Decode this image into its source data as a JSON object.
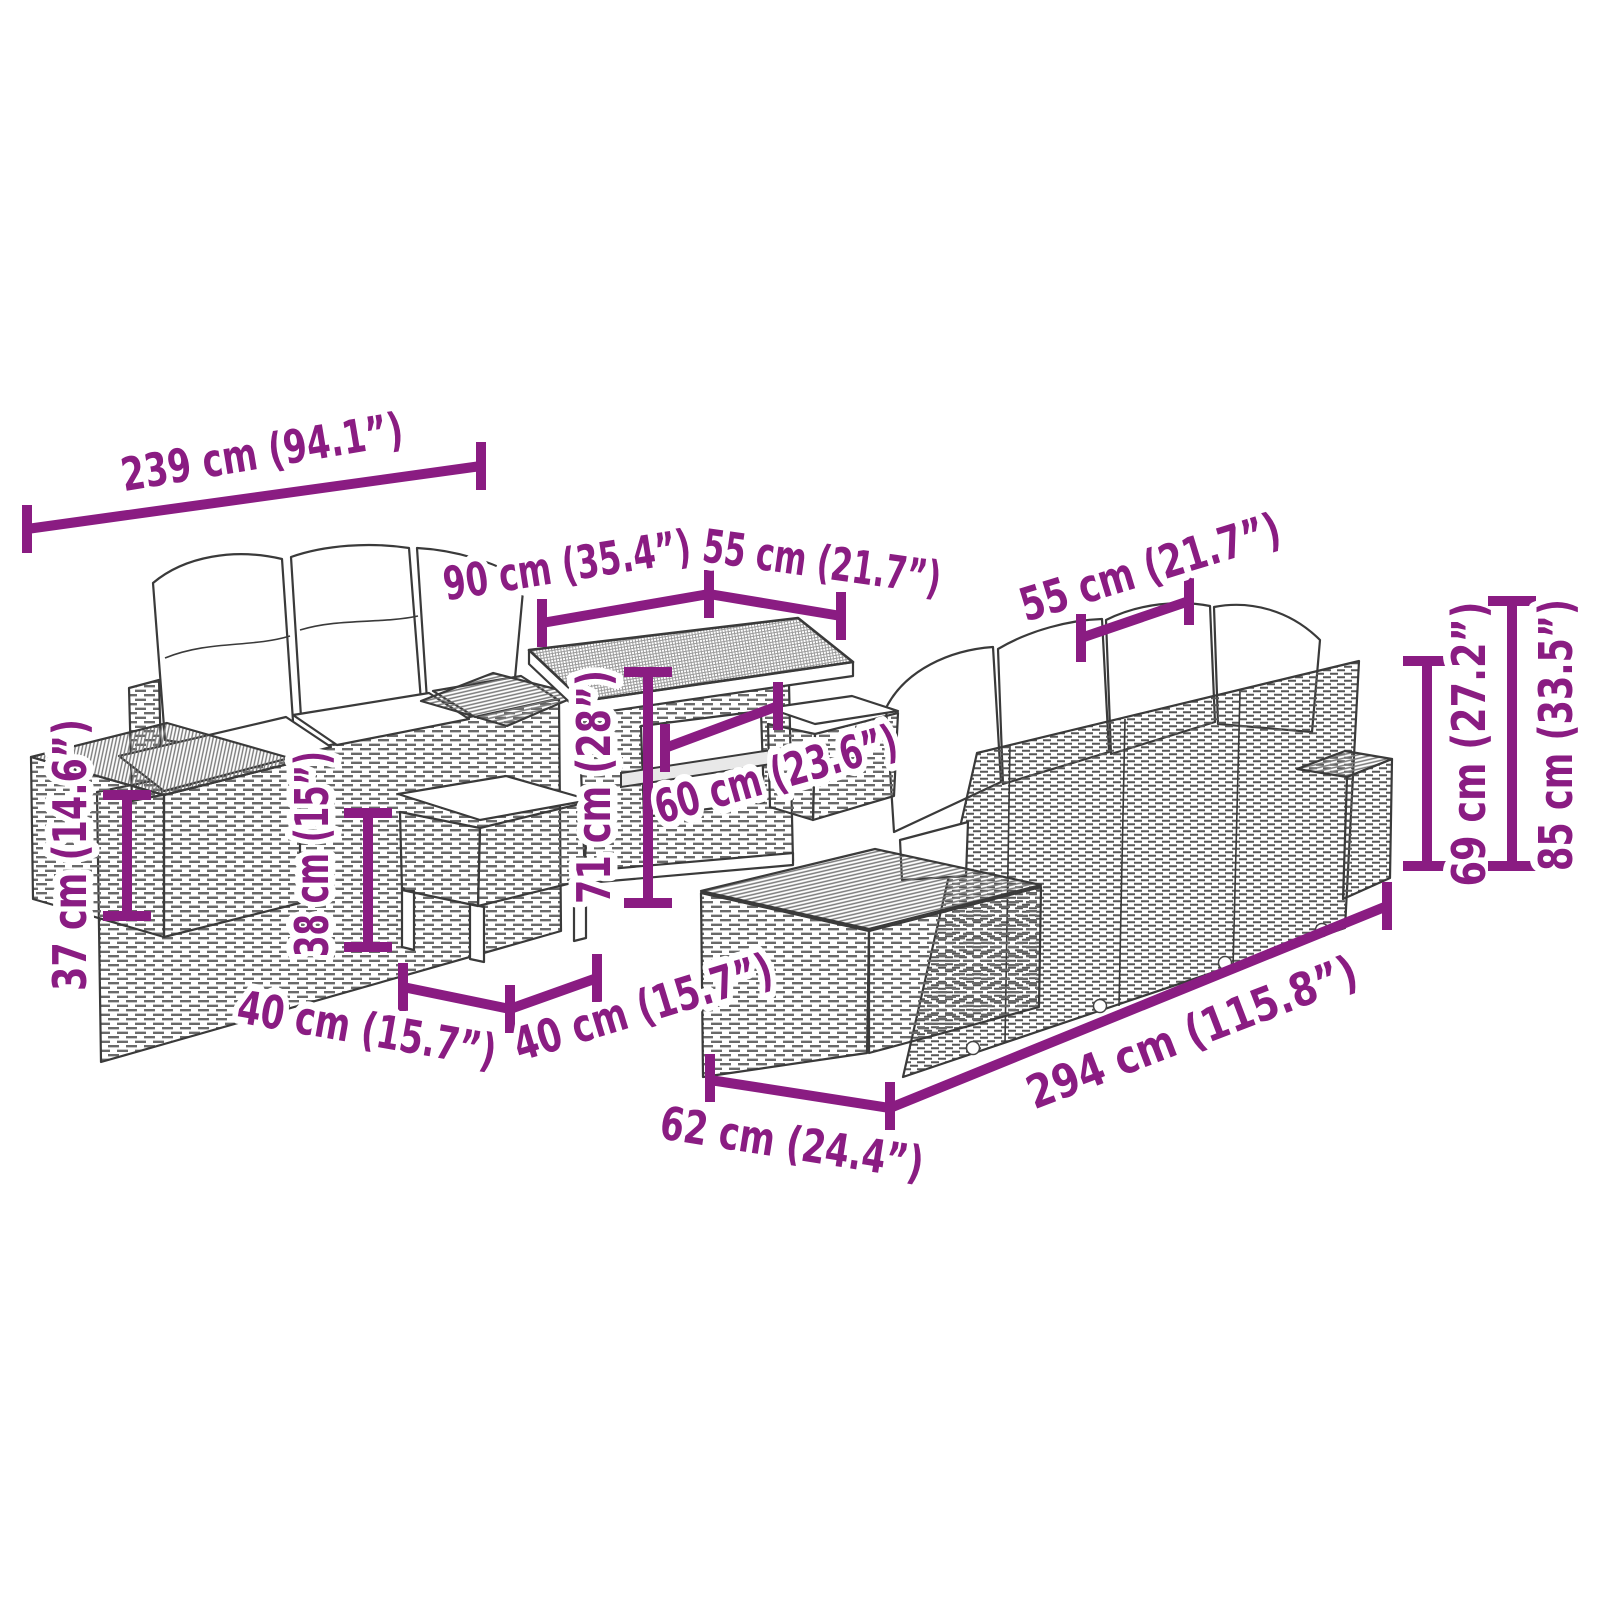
{
  "page": {
    "background": "#ffffff",
    "accent_color": "#8A1C82",
    "line_color": "#3a3a3a",
    "type": "product-dimension-diagram"
  },
  "furniture": [
    "three-seater-garden-sofa-with-cushions",
    "left-side-table",
    "garden-stool-with-cushion",
    "adjustable-garden-table",
    "small-garden-stool-with-cushion",
    "corner-garden-sofa-rear-view",
    "ottoman-with-slatted-top"
  ],
  "dims": {
    "sofa_left_width": "239 cm (94.1”)",
    "table_width": "90 cm (35.4”)",
    "seat_width_front": "55 cm (21.7”)",
    "seat_width_back": "55 cm (21.7”)",
    "side_table_height": "37 cm (14.6”)",
    "stool_height": "38 cm (15”)",
    "table_height": "71 cm (28”)",
    "table_depth": "60 cm (23.6”)",
    "stool_width": "40 cm (15.7”)",
    "stool_depth": "40 cm (15.7”)",
    "ottoman_width": "62 cm (24.4”)",
    "sofa_right_width": "294 cm (115.8”)",
    "back_height": "69 cm (27.2”)",
    "total_height": "85 cm (33.5”)"
  }
}
